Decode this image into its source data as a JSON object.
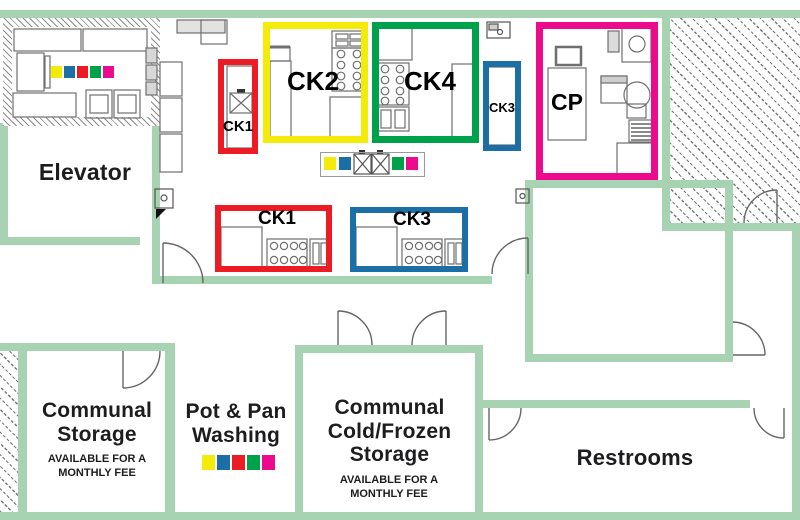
{
  "colors": {
    "wall": "#A7D3B2",
    "red": "#EC1C24",
    "yellow": "#F5EB0B",
    "green": "#00A14B",
    "blue": "#1B6FA5",
    "pink": "#EC0B8C"
  },
  "rooms": {
    "elevator": {
      "name": "Elevator"
    },
    "communal_storage": {
      "name": "Communal Storage",
      "note": "AVAILABLE FOR A MONTHLY FEE"
    },
    "pot_pan_washing": {
      "name": "Pot & Pan Washing"
    },
    "cold_storage": {
      "name": "Communal Cold/Frozen Storage",
      "note": "AVAILABLE FOR A MONTHLY FEE"
    },
    "restrooms": {
      "name": "Restrooms"
    }
  },
  "kitchens": {
    "ck1_top": {
      "label": "CK1",
      "color_key": "red"
    },
    "ck2": {
      "label": "CK2",
      "color_key": "yellow"
    },
    "ck4": {
      "label": "CK4",
      "color_key": "green"
    },
    "ck3_top": {
      "label": "CK3",
      "color_key": "blue"
    },
    "cp": {
      "label": "CP",
      "color_key": "pink"
    },
    "ck1_line": {
      "label": "CK1",
      "color_key": "red"
    },
    "ck3_line": {
      "label": "CK3",
      "color_key": "blue"
    }
  },
  "swatch_strips": {
    "prep_room": [
      "yellow",
      "blue",
      "red",
      "green",
      "pink"
    ],
    "center_station": [
      "yellow",
      "blue",
      "green",
      "pink"
    ],
    "pot_pan": [
      "yellow",
      "blue",
      "red",
      "green",
      "pink"
    ]
  }
}
